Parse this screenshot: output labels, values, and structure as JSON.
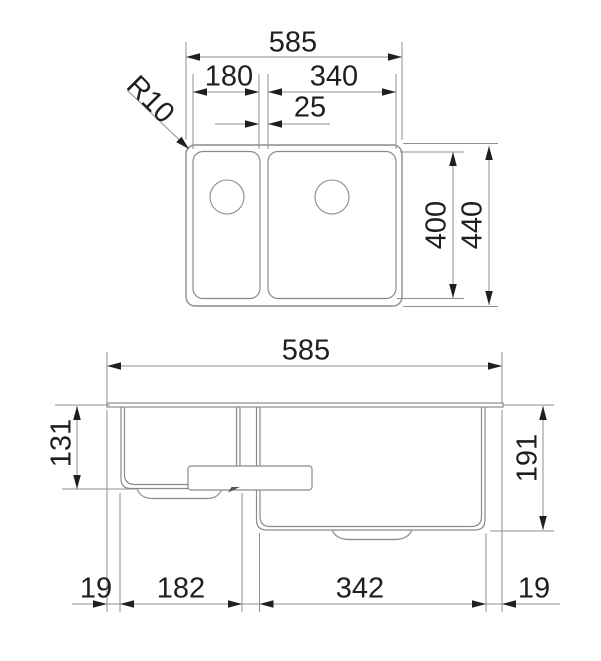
{
  "drawing_type": "sink-dimension-diagram",
  "colors": {
    "outline": "#8a8a8a",
    "dimension_line": "#8f8f8f",
    "arrow_and_text": "#1f1f1f",
    "background": "#ffffff"
  },
  "top_view": {
    "labels": {
      "overall_width": "585",
      "left_bowl_width": "180",
      "right_bowl_width": "340",
      "bowl_gap": "25",
      "corner_radius": "R10",
      "bowl_length": "400",
      "overall_length": "440"
    }
  },
  "front_view": {
    "labels": {
      "overall_width": "585",
      "left_bowl_depth": "131",
      "right_bowl_depth": "191",
      "left_margin": "19",
      "left_bowl_bottom_width": "182",
      "right_bowl_bottom_width": "342",
      "right_margin": "19"
    }
  }
}
